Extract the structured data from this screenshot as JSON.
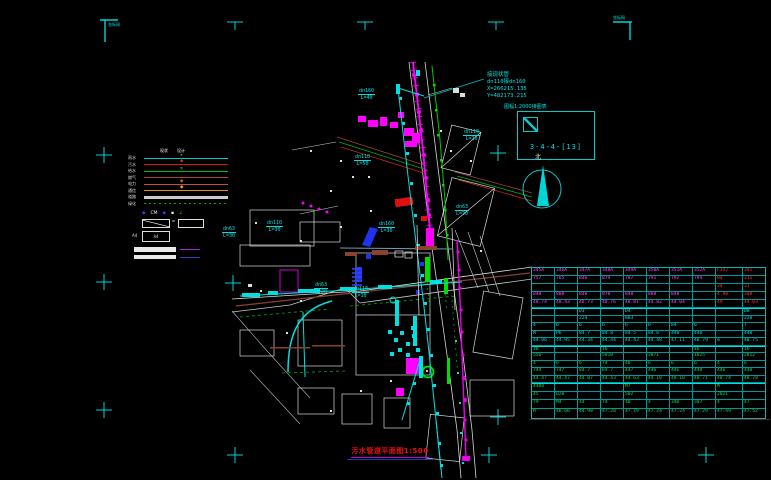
{
  "colors": {
    "cyan": "#00e0e0",
    "magenta": "#ff00ff",
    "red": "#ff3333",
    "green": "#00dd00",
    "white": "#e8e8e8",
    "blue": "#2233ee",
    "orange": "#ee8800",
    "brown": "#8b4030"
  },
  "title": {
    "text": "污水管道平面图1:500"
  },
  "sheet": {
    "caption": "图幅1:2000接图表",
    "number": "3-4-4-[13]"
  },
  "north": {
    "label": "北"
  },
  "annotation": {
    "line1": "接现状管",
    "line2": "dn110接dn160",
    "line3": "X=266215.135",
    "line4": "Y=482173.215"
  },
  "frame_notes": {
    "top_left": "坐标网",
    "top_right": "坐标网"
  },
  "legend": {
    "headers": [
      "现状",
      "设计"
    ],
    "lines": [
      {
        "label": "雨水",
        "color": "#00cccc",
        "style": "solid",
        "marker": "◂",
        "marker_color": "#00cc00"
      },
      {
        "label": "污水",
        "color": "#dd1111",
        "style": "solid",
        "marker": "◆",
        "marker_color": "#dd2222"
      },
      {
        "label": "给水",
        "color": "#00bb00",
        "style": "solid",
        "marker": "◂",
        "marker_color": "#00dd00"
      },
      {
        "label": "燃气",
        "color": "#aa4444",
        "style": "solid",
        "marker": ""
      },
      {
        "label": "电力",
        "color": "#bb5533",
        "style": "solid",
        "marker": "◆",
        "marker_color": "#dd5544"
      },
      {
        "label": "通信",
        "color": "#ee8800",
        "style": "solid",
        "marker": "◆",
        "marker_color": "#ffaa00"
      },
      {
        "label": "道路",
        "color": "#cccccc",
        "style": "thick",
        "marker": ""
      },
      {
        "label": "绿化",
        "color": "#00aa00",
        "style": "dotted",
        "marker": ""
      }
    ],
    "symbols": [
      {
        "glyph": "◆",
        "color": "#3344ff"
      },
      {
        "glyph": "CM",
        "color": "#eeeeee"
      },
      {
        "glyph": "◆",
        "color": "#3344ff"
      },
      {
        "glyph": "▪",
        "color": "#eeeeee"
      },
      {
        "glyph": "∠",
        "color": "#00bb00"
      }
    ],
    "eq_sign": "=",
    "a_note": "A4",
    "a_box_label": "A4"
  },
  "pipe_labels": [
    {
      "dn": "dn160",
      "len": "L=40"
    },
    {
      "dn": "dn110",
      "len": "L=50"
    },
    {
      "dn": "dn110",
      "len": "L=20"
    },
    {
      "dn": "dn160",
      "len": "L=30"
    },
    {
      "dn": "dn110",
      "len": "L=30"
    },
    {
      "dn": "dn63",
      "len": "L=30"
    },
    {
      "dn": "dn63",
      "len": "L=20"
    },
    {
      "dn": "dn110",
      "len": "L=10"
    },
    {
      "dn": "dn63",
      "len": "L=20"
    }
  ],
  "table": {
    "sections": [
      {
        "color": "#ff44ff",
        "red_cols": [
          8,
          9
        ],
        "rows": [
          [
            "345A",
            "346A",
            "347A",
            "348A",
            "349A",
            "350A",
            "351A",
            "352A",
            "F342",
            "341"
          ],
          [
            "757",
            "765",
            "846",
            "879",
            "787",
            "791",
            "792",
            "794",
            "84",
            "211"
          ],
          [
            "",
            "",
            "",
            "",
            "",
            "",
            "",
            "",
            "34",
            "21"
          ],
          [
            "848",
            "888",
            "848",
            "878",
            "848",
            "888",
            "848",
            "",
            "4.98",
            "348"
          ],
          [
            "48.74",
            "48.43",
            "48.73",
            "48.76",
            "48.81",
            "44.82",
            "44.04",
            "",
            "49",
            "44.03"
          ]
        ]
      },
      {
        "color": "#00e0e0",
        "rows": [
          [
            "",
            "",
            "D3",
            "",
            "D4",
            "",
            "",
            "",
            "",
            "D8"
          ],
          [
            "",
            "",
            "224",
            "",
            "883",
            "",
            "",
            "",
            "",
            "228"
          ],
          [
            "4",
            "6",
            "6",
            "6",
            "6",
            "6",
            "84",
            "6",
            "",
            "7"
          ],
          [
            "M",
            "P6",
            "84.7",
            "84.8",
            "84.5",
            "84.6",
            "448",
            "448",
            "",
            "448"
          ],
          [
            "44.06",
            "44.95",
            "44.34",
            "44.44",
            "44.43",
            "44.48",
            "47.11",
            "48.79",
            "m",
            "48.75"
          ]
        ]
      },
      {
        "color": "#00dd55",
        "rows": [
          [
            "16",
            "",
            "",
            "16",
            "",
            "",
            "",
            "16",
            "",
            "16"
          ],
          [
            "556",
            "",
            "",
            "5810",
            "",
            "3871",
            "",
            "1825",
            "",
            "2812"
          ],
          [
            "4",
            "6",
            "6",
            "74",
            "40",
            "6",
            "6",
            "6",
            "4",
            "6"
          ],
          [
            "744",
            "747",
            "84.7",
            "84.7",
            "447",
            "446",
            "446",
            "448",
            "446",
            "448"
          ],
          [
            "44.47",
            "44.47",
            "44.07",
            "44.43",
            "44.63",
            "44.10",
            "48.10",
            "48.71",
            "48.74",
            "48.78"
          ]
        ]
      },
      {
        "color": "#00dd55",
        "rows": [
          [
            "4488",
            "",
            "",
            "",
            "M7",
            "",
            "",
            "",
            "M",
            ""
          ],
          [
            "45",
            "D20",
            "",
            "",
            "502",
            "",
            "",
            "",
            "2021",
            ""
          ],
          [
            "79",
            "M4",
            "44",
            "74",
            "40",
            "4",
            "340",
            "387",
            "4",
            "47"
          ],
          [
            "M",
            "46.66",
            "44.98",
            "47.28",
            "47.19",
            "47.24",
            "47.24",
            "47.29",
            "47.49",
            "47.52"
          ]
        ]
      }
    ]
  }
}
